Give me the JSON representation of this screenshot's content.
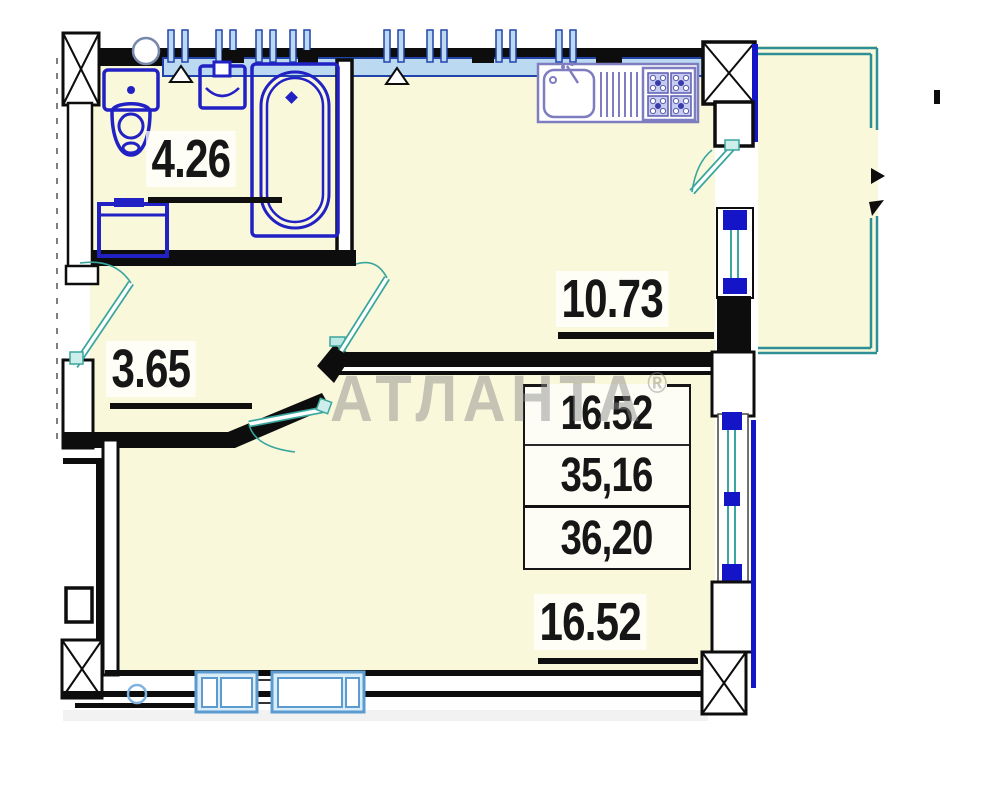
{
  "watermark": {
    "text": "АТЛАНТА",
    "reg": "®"
  },
  "rooms": {
    "bathroom": {
      "area": "4.26"
    },
    "kitchen": {
      "area": "10.73"
    },
    "hallway": {
      "area": "3.65"
    },
    "living": {
      "area": "16.52"
    }
  },
  "area_table": {
    "living_area": "16.52",
    "apartment_area": "35,16",
    "total_area": "36,20"
  },
  "colors": {
    "room_fill": "#faf8da",
    "wall_black": "#0d0d0d",
    "fixture_blue": "#2121c4",
    "kitchen_unit_blue": "#7d7dc0",
    "window_frame_blue": "#5b9bd0",
    "window_fill_blue": "#d9ecf8",
    "vent_fill_blue": "#bcd9f2",
    "vent_line_blue": "#2244aa",
    "door_teal": "#3aa69d",
    "balcony_teal": "#2e8f96",
    "accent_dark_blue": "#1515c8",
    "watermark_gray": "#c9c9c9"
  }
}
